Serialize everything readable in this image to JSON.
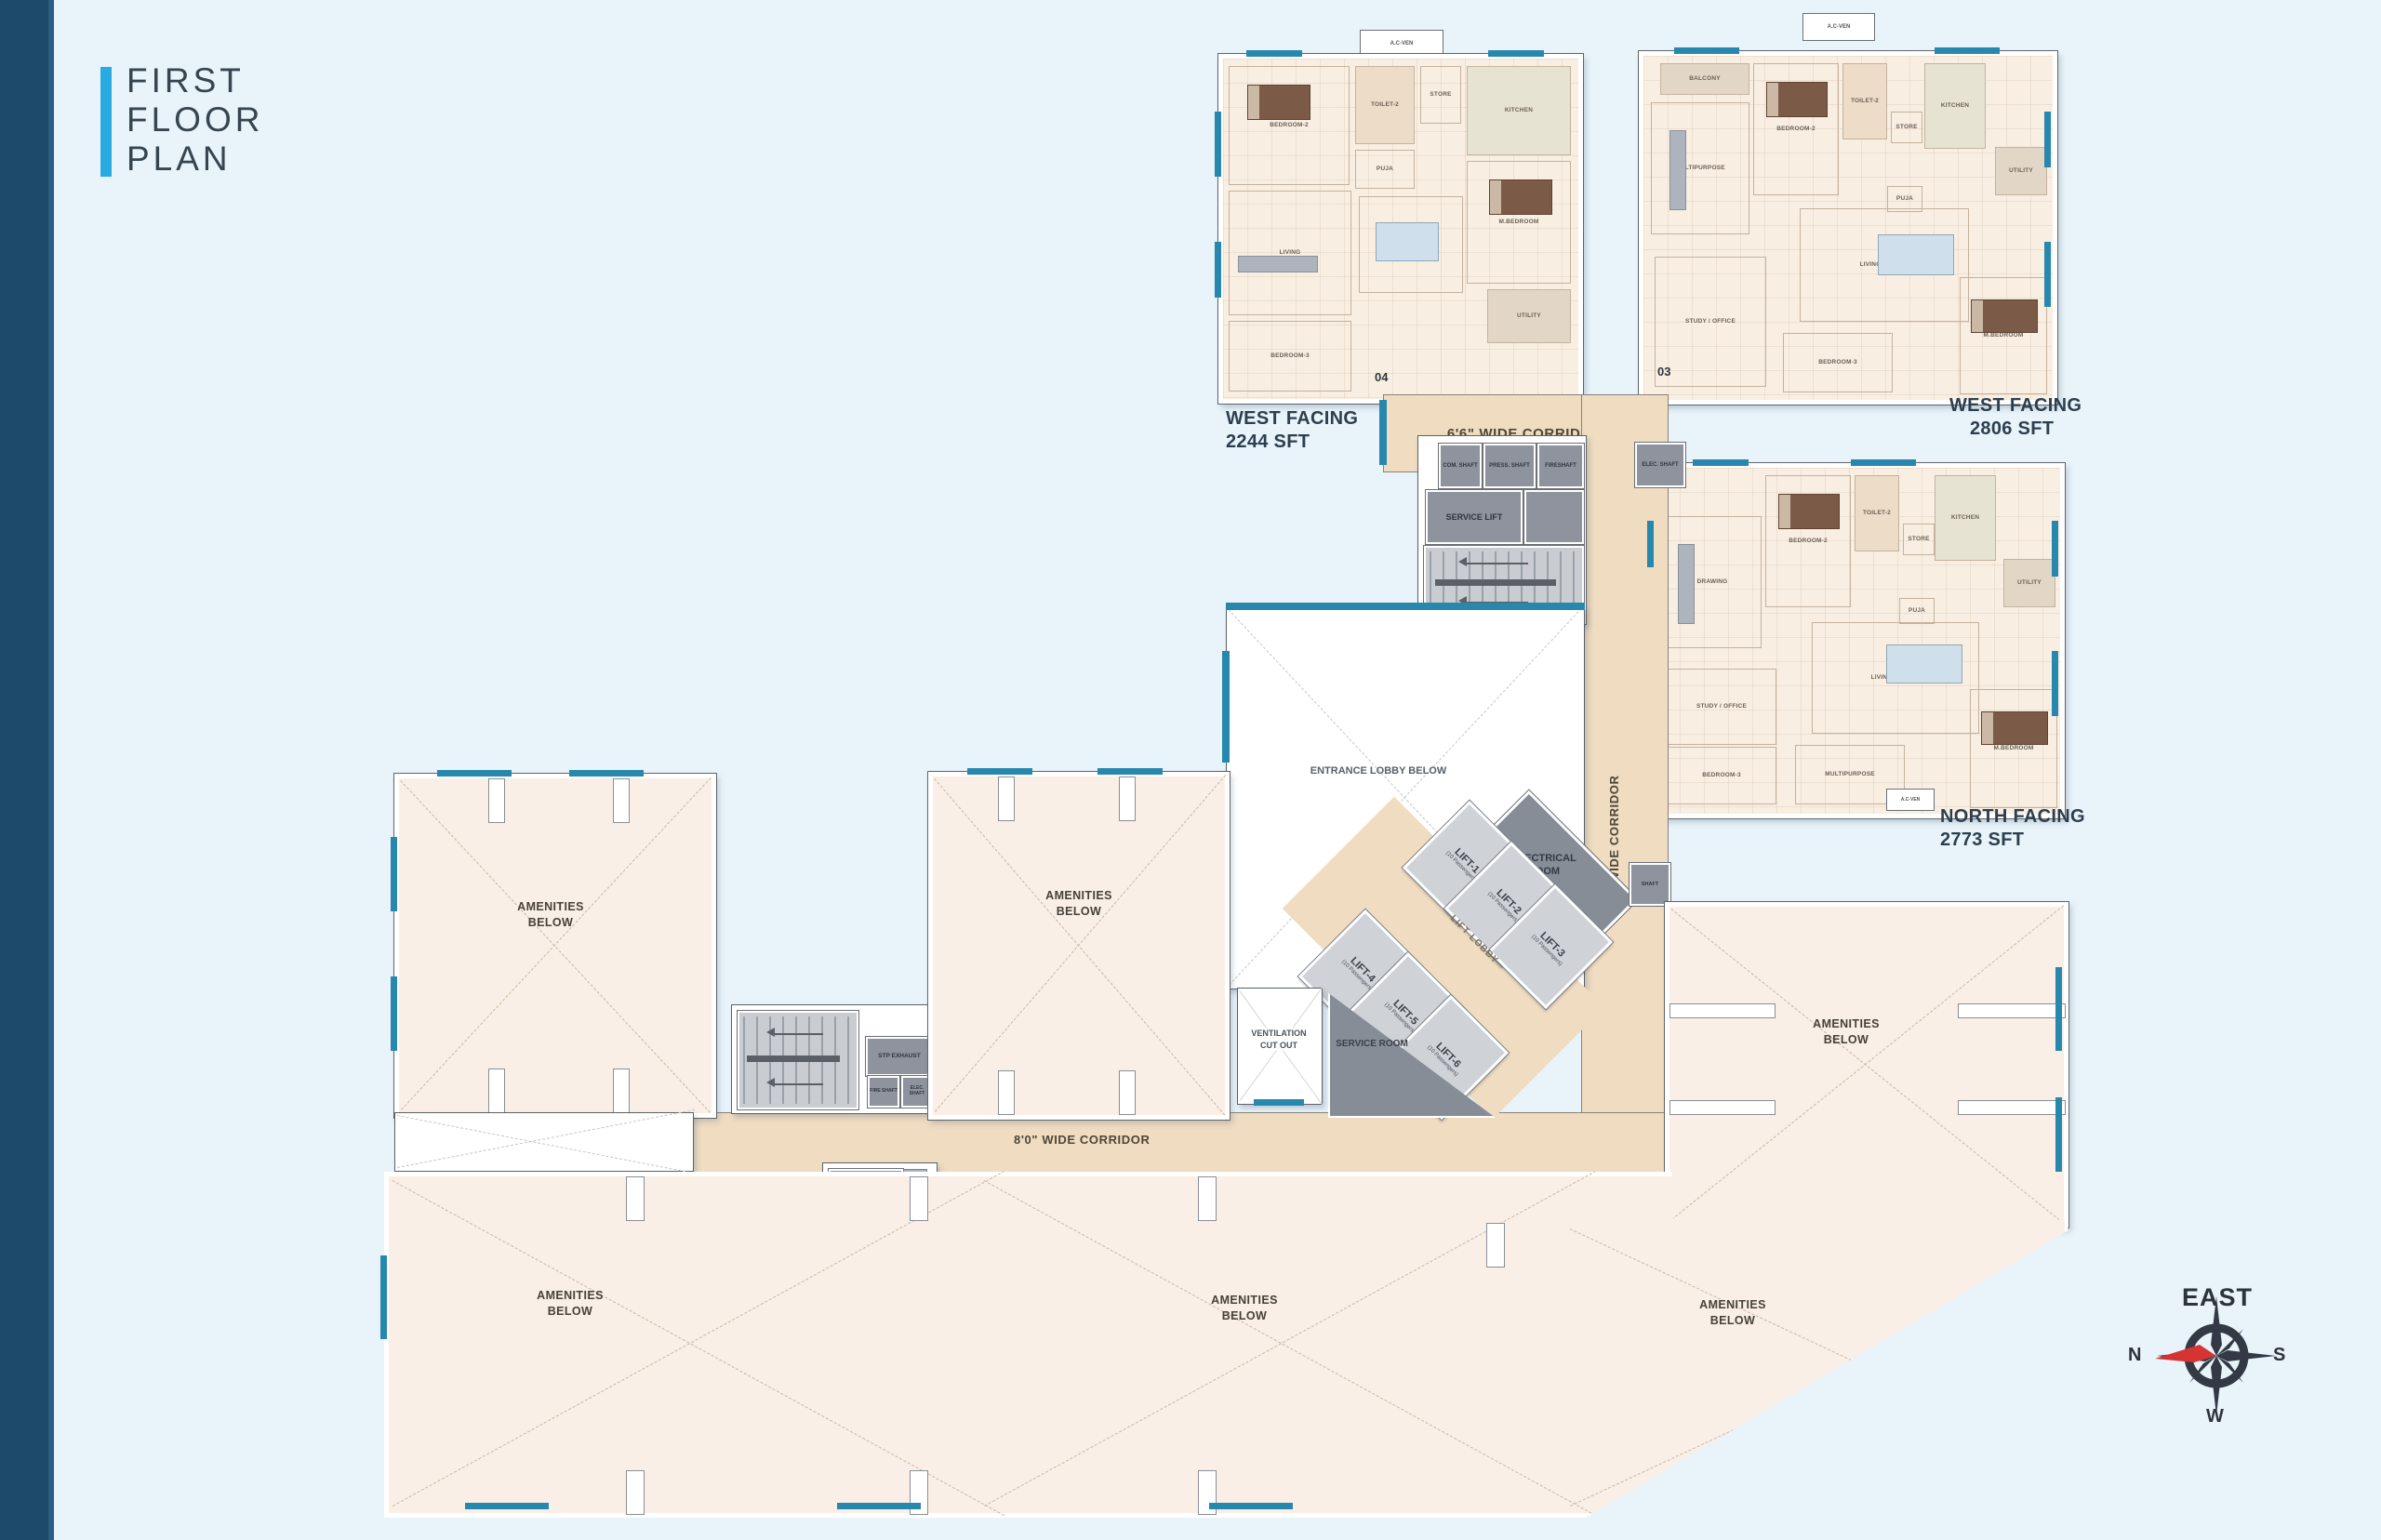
{
  "title": {
    "line1": "FIRST",
    "line2": "FLOOR",
    "line3": "PLAN"
  },
  "units": [
    {
      "id": "04",
      "facing": "WEST FACING",
      "area": "2244 SFT",
      "rooms": [
        "BEDROOM-2",
        "TOILET-2",
        "PUJA",
        "STORE",
        "KITCHEN",
        "DINING",
        "LIVING",
        "M.BEDROOM",
        "BEDROOM-3",
        "UTILITY"
      ]
    },
    {
      "id": "03",
      "facing": "WEST FACING",
      "area": "2806 SFT",
      "rooms": [
        "BALCONY",
        "MULTIPURPOSE",
        "BEDROOM-2",
        "TOILET-2",
        "STORE",
        "KITCHEN",
        "UTILITY",
        "PUJA",
        "LIVING / DINING",
        "STUDY / OFFICE",
        "BEDROOM-3",
        "M.BEDROOM"
      ]
    },
    {
      "id": "02",
      "facing": "NORTH FACING",
      "area": "2773 SFT",
      "rooms": [
        "DRAWING",
        "BEDROOM-2",
        "TOILET-2",
        "STORE",
        "KITCHEN",
        "UTILITY",
        "PUJA",
        "LIVING / DINING",
        "STUDY / OFFICE",
        "BEDROOM-3",
        "MULTIPURPOSE",
        "M.BEDROOM"
      ]
    }
  ],
  "corridors": {
    "top": "6'6\" WIDE CORRIDOR",
    "vertical": "8'0\" WIDE CORRIDOR",
    "bottom": "8'0\" WIDE CORRIDOR"
  },
  "core": {
    "com_shaft": "COM. SHAFT",
    "press_shaft": "PRESS. SHAFT",
    "fire_shaft_top": "FIRESHAFT",
    "service_lift": "SERVICE LIFT",
    "elec_shaft_unit": "ELEC. SHAFT",
    "shaft_small": "SHAFT",
    "entrance_lobby": "ENTRANCE LOBBY BELOW",
    "electrical_room": "ELECTRICAL ROOM",
    "lift_lobby": "LIFT LOBBY",
    "service_room": "SERVICE ROOM",
    "ventilation": "VENTILATION CUT OUT",
    "stp_exhaust": "STP EXHAUST",
    "fire_shaft": "FIRE SHAFT",
    "elec_shaft": "ELEC. SHAFT",
    "garbage_room": "GARBAGE ROOM",
    "toilet_note": "Toilet @ Every 5 Floors",
    "chute": "CHUTE & VENT",
    "ac_ven": "A.C-VEN"
  },
  "lifts": [
    {
      "name": "LIFT-1",
      "capacity": "(10 Passengers)"
    },
    {
      "name": "LIFT-2",
      "capacity": "(10 Passengers)"
    },
    {
      "name": "LIFT-3",
      "capacity": "(10 Passengers)"
    },
    {
      "name": "LIFT-4",
      "capacity": "(10 Passengers)"
    },
    {
      "name": "LIFT-5",
      "capacity": "(10 Passengers)"
    },
    {
      "name": "LIFT-6",
      "capacity": "(10 Passengers)"
    }
  ],
  "amenities": {
    "label": "AMENITIES BELOW"
  },
  "compass": {
    "heading": "EAST",
    "left": "N",
    "right": "S",
    "bottom": "W"
  },
  "colors": {
    "accent": "#29ABE2",
    "navy": "#1D4A6B",
    "teal_wall": "#2787AD",
    "corridor": "#EFDCC1",
    "floor": "#F9EEE2",
    "core_gray": "#8E939D"
  }
}
